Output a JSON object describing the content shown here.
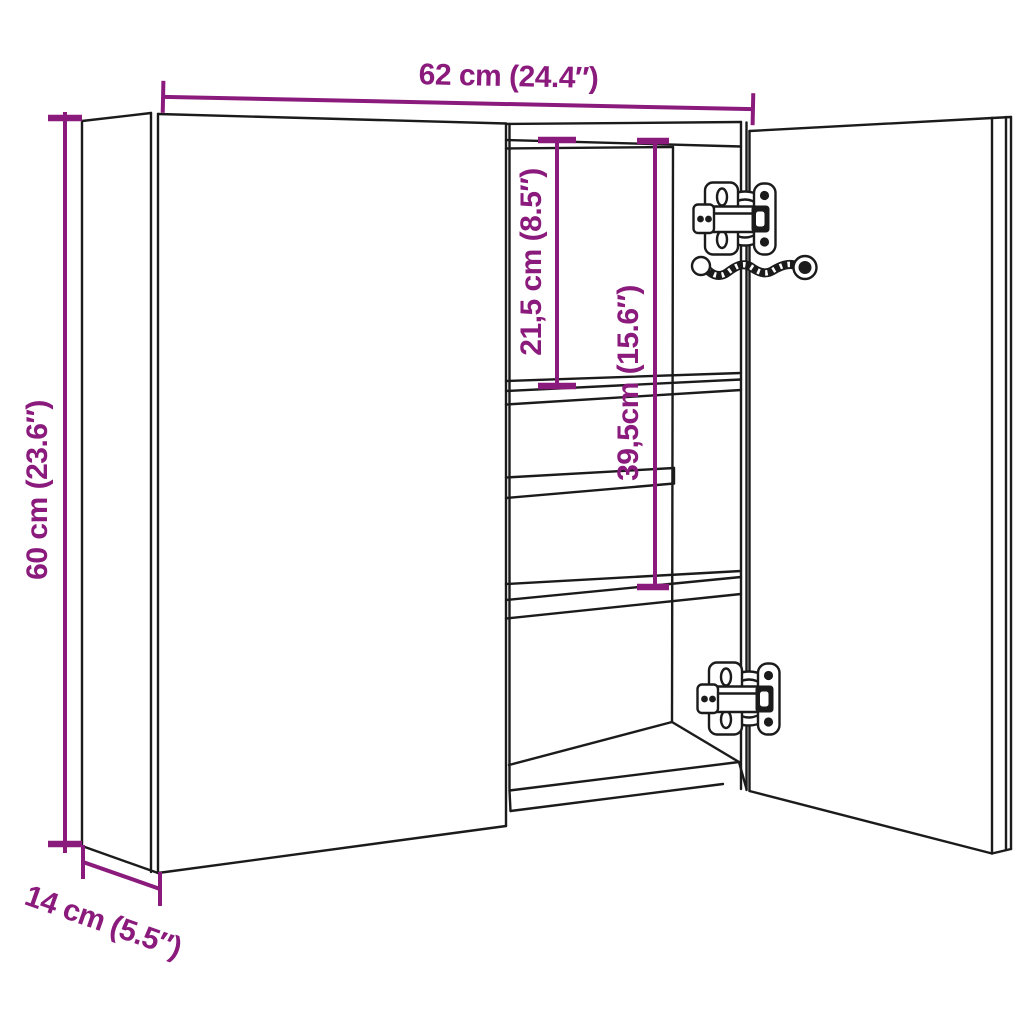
{
  "diagram": {
    "type": "product-dimension-line-drawing",
    "subject": "two-door mirror cabinet with shelves, concealed hinges and cable",
    "colors": {
      "accent": "#8B1A7D",
      "line": "#1B1B1B",
      "background": "#FFFFFF"
    },
    "dimensions": {
      "width": {
        "label": "62 cm (24.4″)"
      },
      "height": {
        "label": "60 cm (23.6″)"
      },
      "depth": {
        "label": "14 cm (5.5″)"
      },
      "top_shelf": {
        "label": "21,5 cm (8.5″)"
      },
      "middle_shelf": {
        "label": "39,5cm (15.6″)"
      }
    }
  }
}
